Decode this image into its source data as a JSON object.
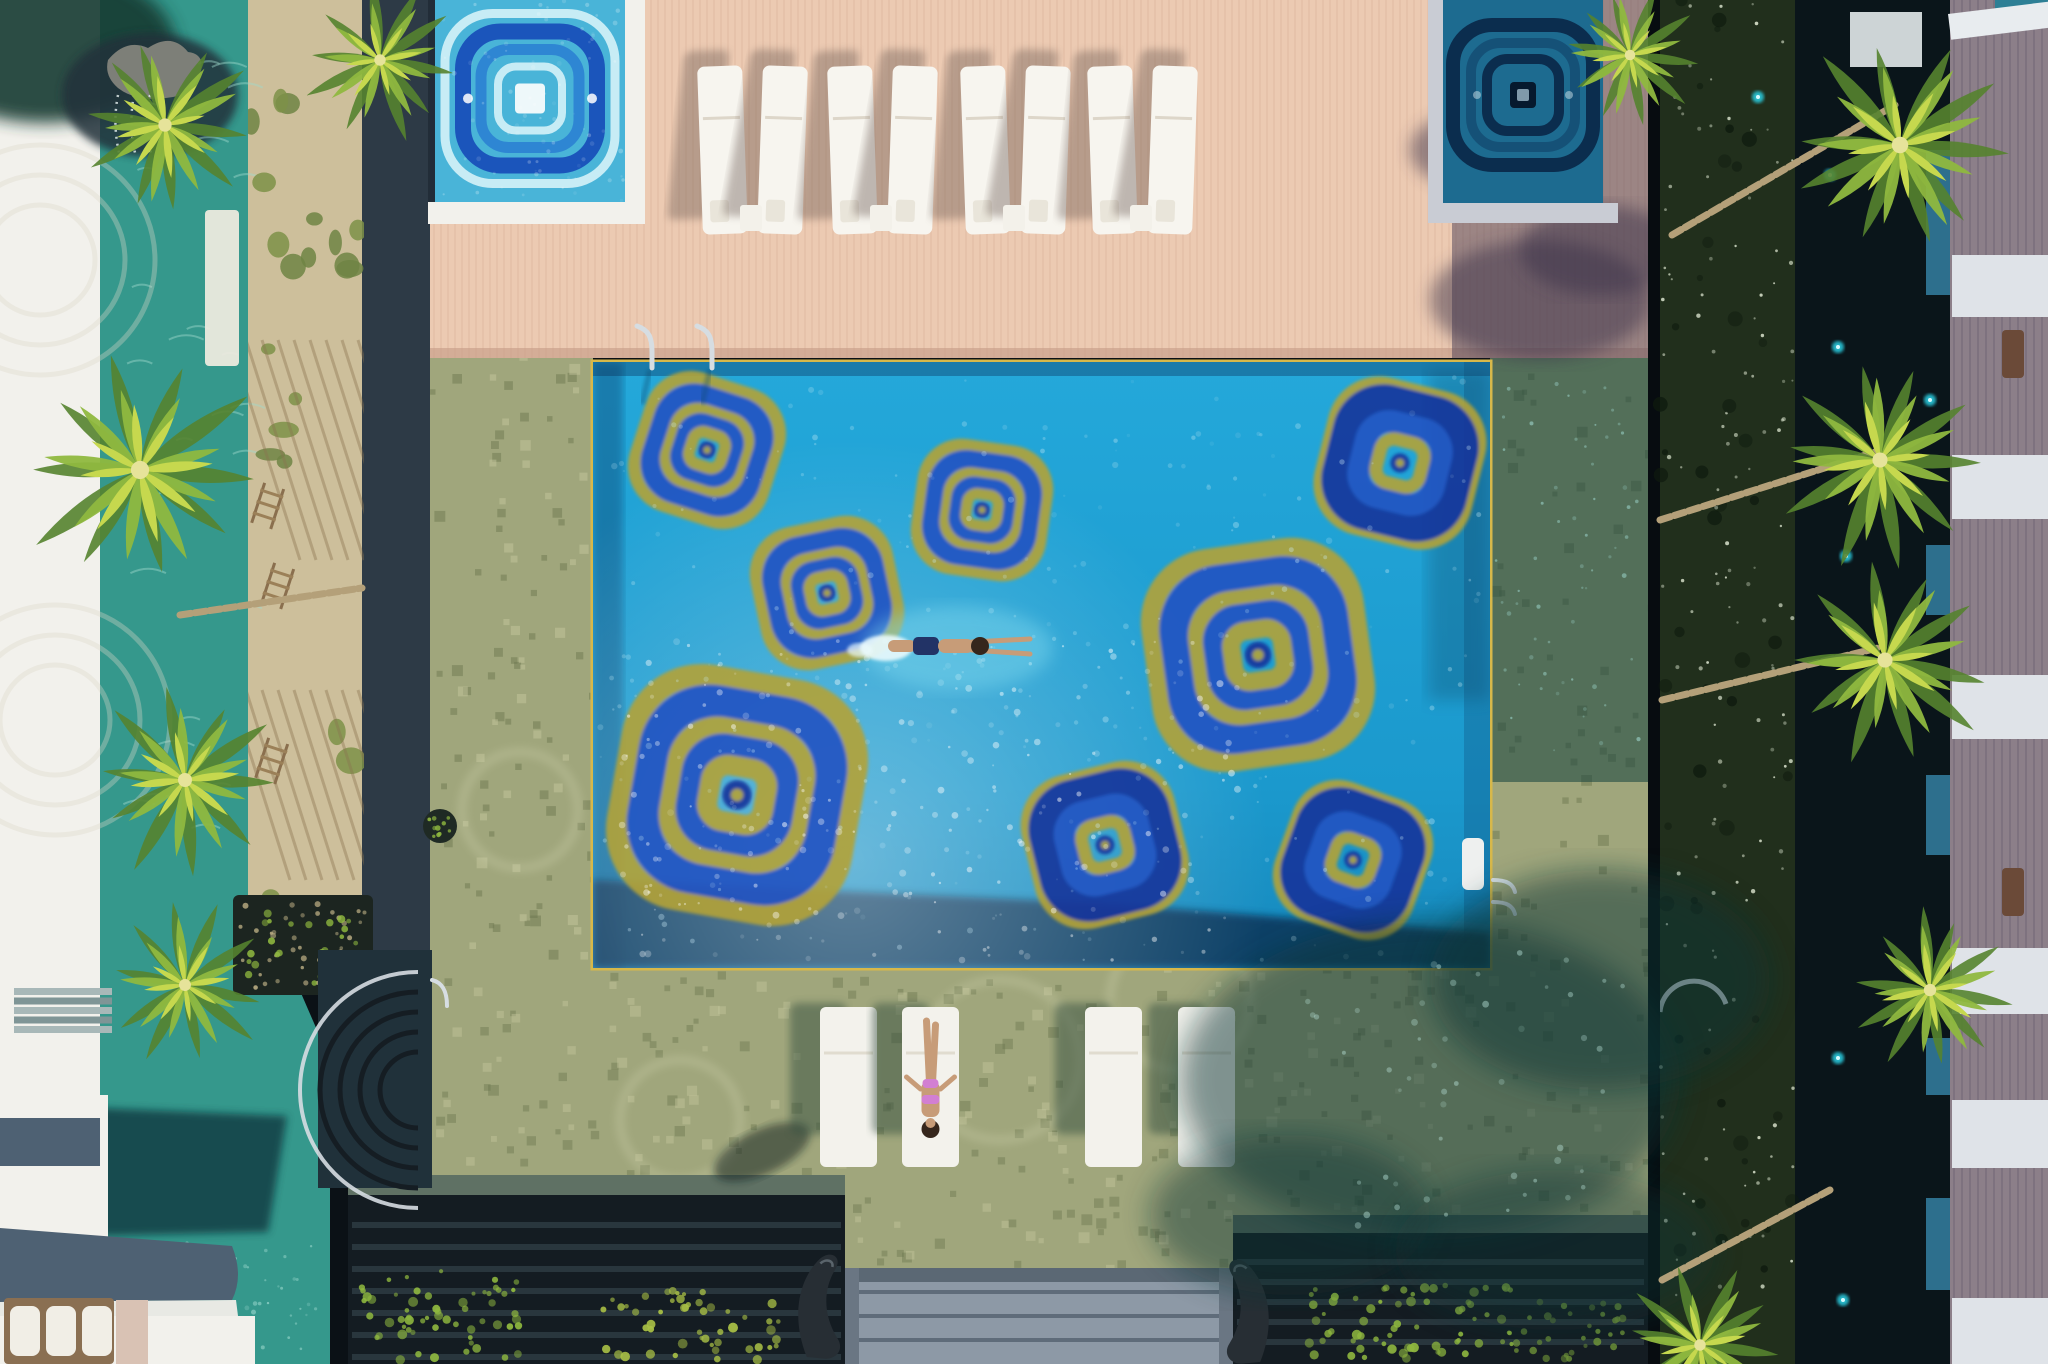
{
  "image": {
    "width": 2048,
    "height": 1364,
    "label": "Aerial view of a resort swimming pool with blue-and-gold mosaic medallions, wooden sun deck, two mosaic jacuzzis, palm-lined lagoon and villas"
  },
  "palette": {
    "deck": "#eccab2",
    "deckPlank": "#d8ad95",
    "deckShade": "#8a7787",
    "stone": "#2d3a46",
    "sand": "#cdbf9b",
    "moss": "#6e8444",
    "lagoon": "#35988c",
    "lagoonDark": "#174f4b",
    "white": "#f2f1ec",
    "tile": "#a0a67c",
    "tileDark": "#6d7850",
    "tileLight": "#c3c59b",
    "tileShade": "#0c3434",
    "poolWater": "#1f9fd3",
    "poolDeep": "#0d3a60",
    "poolTrim": "#d7b84a",
    "sparkle": "#cdeef8",
    "mosaicGold": "#b3a337",
    "mosaicBlue": "#2353c2",
    "mosaicNavy": "#16359b",
    "jacuzziAqua": "#49b4d8",
    "jacuzziBlue": "#1b55bb",
    "jacuzziMid": "#2e86d3",
    "jacuzziPale": "#c7ecf5",
    "jacuzziShadedBase": "#1d6b90",
    "jacuzziShadedRing": "#0b2d4e",
    "hedge": "#212f1c",
    "hedgeDot": "#d9e2cc",
    "pond": "#0a151a",
    "pondLight": "#2bd2e6",
    "roofMauve": "#8c7f89",
    "terraceWhite": "#dfe3e8",
    "plunge": "#2d6f8d",
    "pergola": "#141c22",
    "pergolaTop": "#5f7164",
    "steps": "#8d99a6",
    "stepLine": "#5f6c7a",
    "palmBright": "#c6d84e",
    "palmMid": "#8fb83f",
    "palmDark": "#55832f",
    "trunk": "#b4a079",
    "skin": "#c79c78",
    "swimTrunks": "#223366",
    "bikini": "#d27fd2",
    "hair": "#35261c",
    "statue": "#272e34",
    "chrome": "#d6dde2",
    "awning": "#4e6173",
    "wood": "#8a6f52"
  },
  "pool": {
    "x": 593,
    "y": 362,
    "w": 897,
    "h": 606,
    "medallions": [
      {
        "cx": 707,
        "cy": 450,
        "r": 66,
        "rot": 18,
        "style": "gold"
      },
      {
        "cx": 827,
        "cy": 593,
        "r": 66,
        "rot": -12,
        "style": "gold"
      },
      {
        "cx": 982,
        "cy": 510,
        "r": 62,
        "rot": 8,
        "style": "gold"
      },
      {
        "cx": 1400,
        "cy": 463,
        "r": 74,
        "rot": 14,
        "style": "blue"
      },
      {
        "cx": 1258,
        "cy": 655,
        "r": 102,
        "rot": -8,
        "style": "gold"
      },
      {
        "cx": 737,
        "cy": 795,
        "r": 113,
        "rot": 10,
        "style": "gold"
      },
      {
        "cx": 1105,
        "cy": 845,
        "r": 72,
        "rot": -14,
        "style": "blue"
      },
      {
        "cx": 1353,
        "cy": 860,
        "r": 67,
        "rot": 20,
        "style": "blue"
      }
    ],
    "swimmer": {
      "x": 958,
      "y": 646,
      "heading": "right"
    },
    "ladders": [
      {
        "x": 652,
        "y": 362
      },
      {
        "x": 712,
        "y": 362
      }
    ],
    "sideLadder": {
      "x": 1493,
      "y": 880
    },
    "bench": {
      "x": 1462,
      "y": 838,
      "w": 22,
      "h": 52
    }
  },
  "jacuzzis": [
    {
      "side": "left",
      "x": 435,
      "y": 0,
      "w": 190,
      "h": 203,
      "lit": true
    },
    {
      "side": "right",
      "x": 1443,
      "y": 0,
      "w": 160,
      "h": 205,
      "lit": false
    }
  ],
  "deck": {
    "x": 430,
    "y": 0,
    "w": 1218,
    "h": 358,
    "plankStep": 7,
    "loungerPairs": [
      {
        "x": 700
      },
      {
        "x": 830
      },
      {
        "x": 963
      },
      {
        "x": 1090
      }
    ],
    "loungerY": 66,
    "loungerW": 45,
    "loungerH": 168
  },
  "bottomLoungers": {
    "y": 1007,
    "w": 57,
    "h": 160,
    "items": [
      {
        "x": 820
      },
      {
        "x": 902,
        "person": true
      },
      {
        "x": 1085
      },
      {
        "x": 1178
      }
    ]
  },
  "palms": [
    {
      "x": 165,
      "y": 125,
      "r": 95,
      "seed": 1
    },
    {
      "x": 140,
      "y": 470,
      "r": 130,
      "seed": 2
    },
    {
      "x": 185,
      "y": 780,
      "r": 100,
      "seed": 3
    },
    {
      "x": 185,
      "y": 985,
      "r": 85,
      "seed": 4
    },
    {
      "x": 380,
      "y": 60,
      "r": 82,
      "seed": 5
    },
    {
      "x": 1630,
      "y": 55,
      "r": 75,
      "seed": 6
    },
    {
      "x": 1900,
      "y": 145,
      "r": 118,
      "seed": 7
    },
    {
      "x": 1880,
      "y": 460,
      "r": 108,
      "seed": 8
    },
    {
      "x": 1885,
      "y": 660,
      "r": 108,
      "seed": 9
    },
    {
      "x": 1930,
      "y": 990,
      "r": 88,
      "seed": 10
    },
    {
      "x": 1700,
      "y": 1345,
      "r": 82,
      "seed": 11
    }
  ],
  "trunks": [
    {
      "x1": 1672,
      "y1": 235,
      "x2": 1895,
      "y2": 105
    },
    {
      "x1": 1660,
      "y1": 520,
      "x2": 1875,
      "y2": 452
    },
    {
      "x1": 1662,
      "y1": 700,
      "x2": 1878,
      "y2": 648
    },
    {
      "x1": 1662,
      "y1": 1280,
      "x2": 1830,
      "y2": 1190
    },
    {
      "x1": 180,
      "y1": 615,
      "x2": 362,
      "y2": 588
    }
  ],
  "rightVillas": {
    "terraces": [
      {
        "y": 255,
        "h": 62
      },
      {
        "y": 455,
        "h": 64
      },
      {
        "y": 675,
        "h": 64
      },
      {
        "y": 948,
        "h": 66
      },
      {
        "y": 1100,
        "h": 68
      },
      {
        "y": 1298,
        "h": 66
      }
    ],
    "plungeSlots": [
      {
        "y": 150,
        "h": 145
      },
      {
        "y": 545,
        "h": 70
      },
      {
        "y": 775,
        "h": 80
      },
      {
        "y": 1038,
        "h": 57
      },
      {
        "y": 1198,
        "h": 92
      }
    ],
    "hatches": [
      {
        "y": 330
      },
      {
        "y": 868
      }
    ]
  },
  "pondLights": [
    {
      "x": 1758,
      "y": 97
    },
    {
      "x": 1830,
      "y": 175
    },
    {
      "x": 1838,
      "y": 347
    },
    {
      "x": 1846,
      "y": 556
    },
    {
      "x": 1930,
      "y": 400
    },
    {
      "x": 1838,
      "y": 1058
    },
    {
      "x": 1843,
      "y": 1300
    }
  ],
  "treeShadows": [
    {
      "x": 1430,
      "y": 1080,
      "rx": 250,
      "ry": 160,
      "o": 0.5
    },
    {
      "x": 1600,
      "y": 980,
      "rx": 170,
      "ry": 110,
      "o": 0.5
    },
    {
      "x": 1290,
      "y": 1215,
      "rx": 140,
      "ry": 80,
      "o": 0.45
    },
    {
      "x": 1555,
      "y": 1250,
      "rx": 160,
      "ry": 80,
      "o": 0.4
    }
  ],
  "statues": [
    {
      "x": 800,
      "y": 1255,
      "flip": false
    },
    {
      "x": 1267,
      "y": 1260,
      "flip": true
    }
  ],
  "trellis": [
    {
      "x": 268,
      "y": 505
    },
    {
      "x": 278,
      "y": 585
    },
    {
      "x": 272,
      "y": 760
    }
  ]
}
